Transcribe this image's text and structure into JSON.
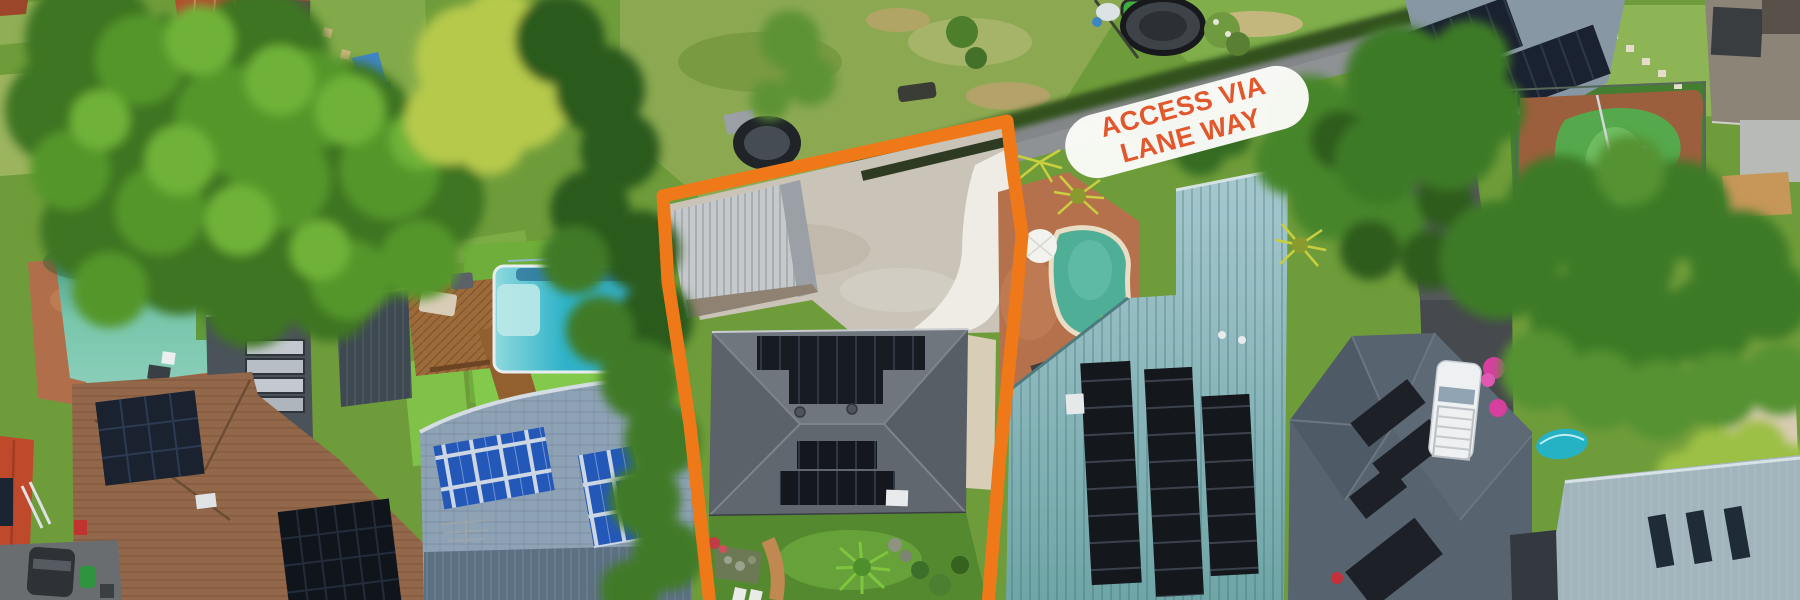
{
  "overlay": {
    "label": {
      "line1": "ACCESS VIA",
      "line2": "LANE WAY",
      "text_color": "#e2572b",
      "pill_color": "#fbfbf8",
      "rotation_deg": -15
    },
    "boundary": {
      "color": "#ef7918",
      "meaning": "highlighted subject property outline"
    }
  },
  "scene": {
    "type": "aerial-drone-photo",
    "subject_property": {
      "driveway_color": "#c9c3b8",
      "roof_color": "#666c74",
      "solar_panel_color": "#14171c",
      "awning_color": "#c6c9cc",
      "lawn_color": "#55892f"
    },
    "neighbourhood": {
      "laneway_color": "#8f9295",
      "hedge_color": "#32511e",
      "left_pool_color": "#58b39c",
      "blue_pool_color": "#2fb3c9",
      "green_pool_color": "#4fae96",
      "kidney_pool_color": "#55a94c",
      "teal_metal_roof_color": "#7fb0b4",
      "terracotta_roof_color": "#b24f2e",
      "brown_tile_roof_color": "#93684a",
      "slate_roof_color": "#57646f",
      "blue_pv_panel_color": "#2458b8",
      "white_ute_color": "#eef0f1",
      "tree_canopy_colors": [
        "#2c5a1b",
        "#3f7a26",
        "#55962c",
        "#6fb237",
        "#b6c94b"
      ]
    }
  }
}
